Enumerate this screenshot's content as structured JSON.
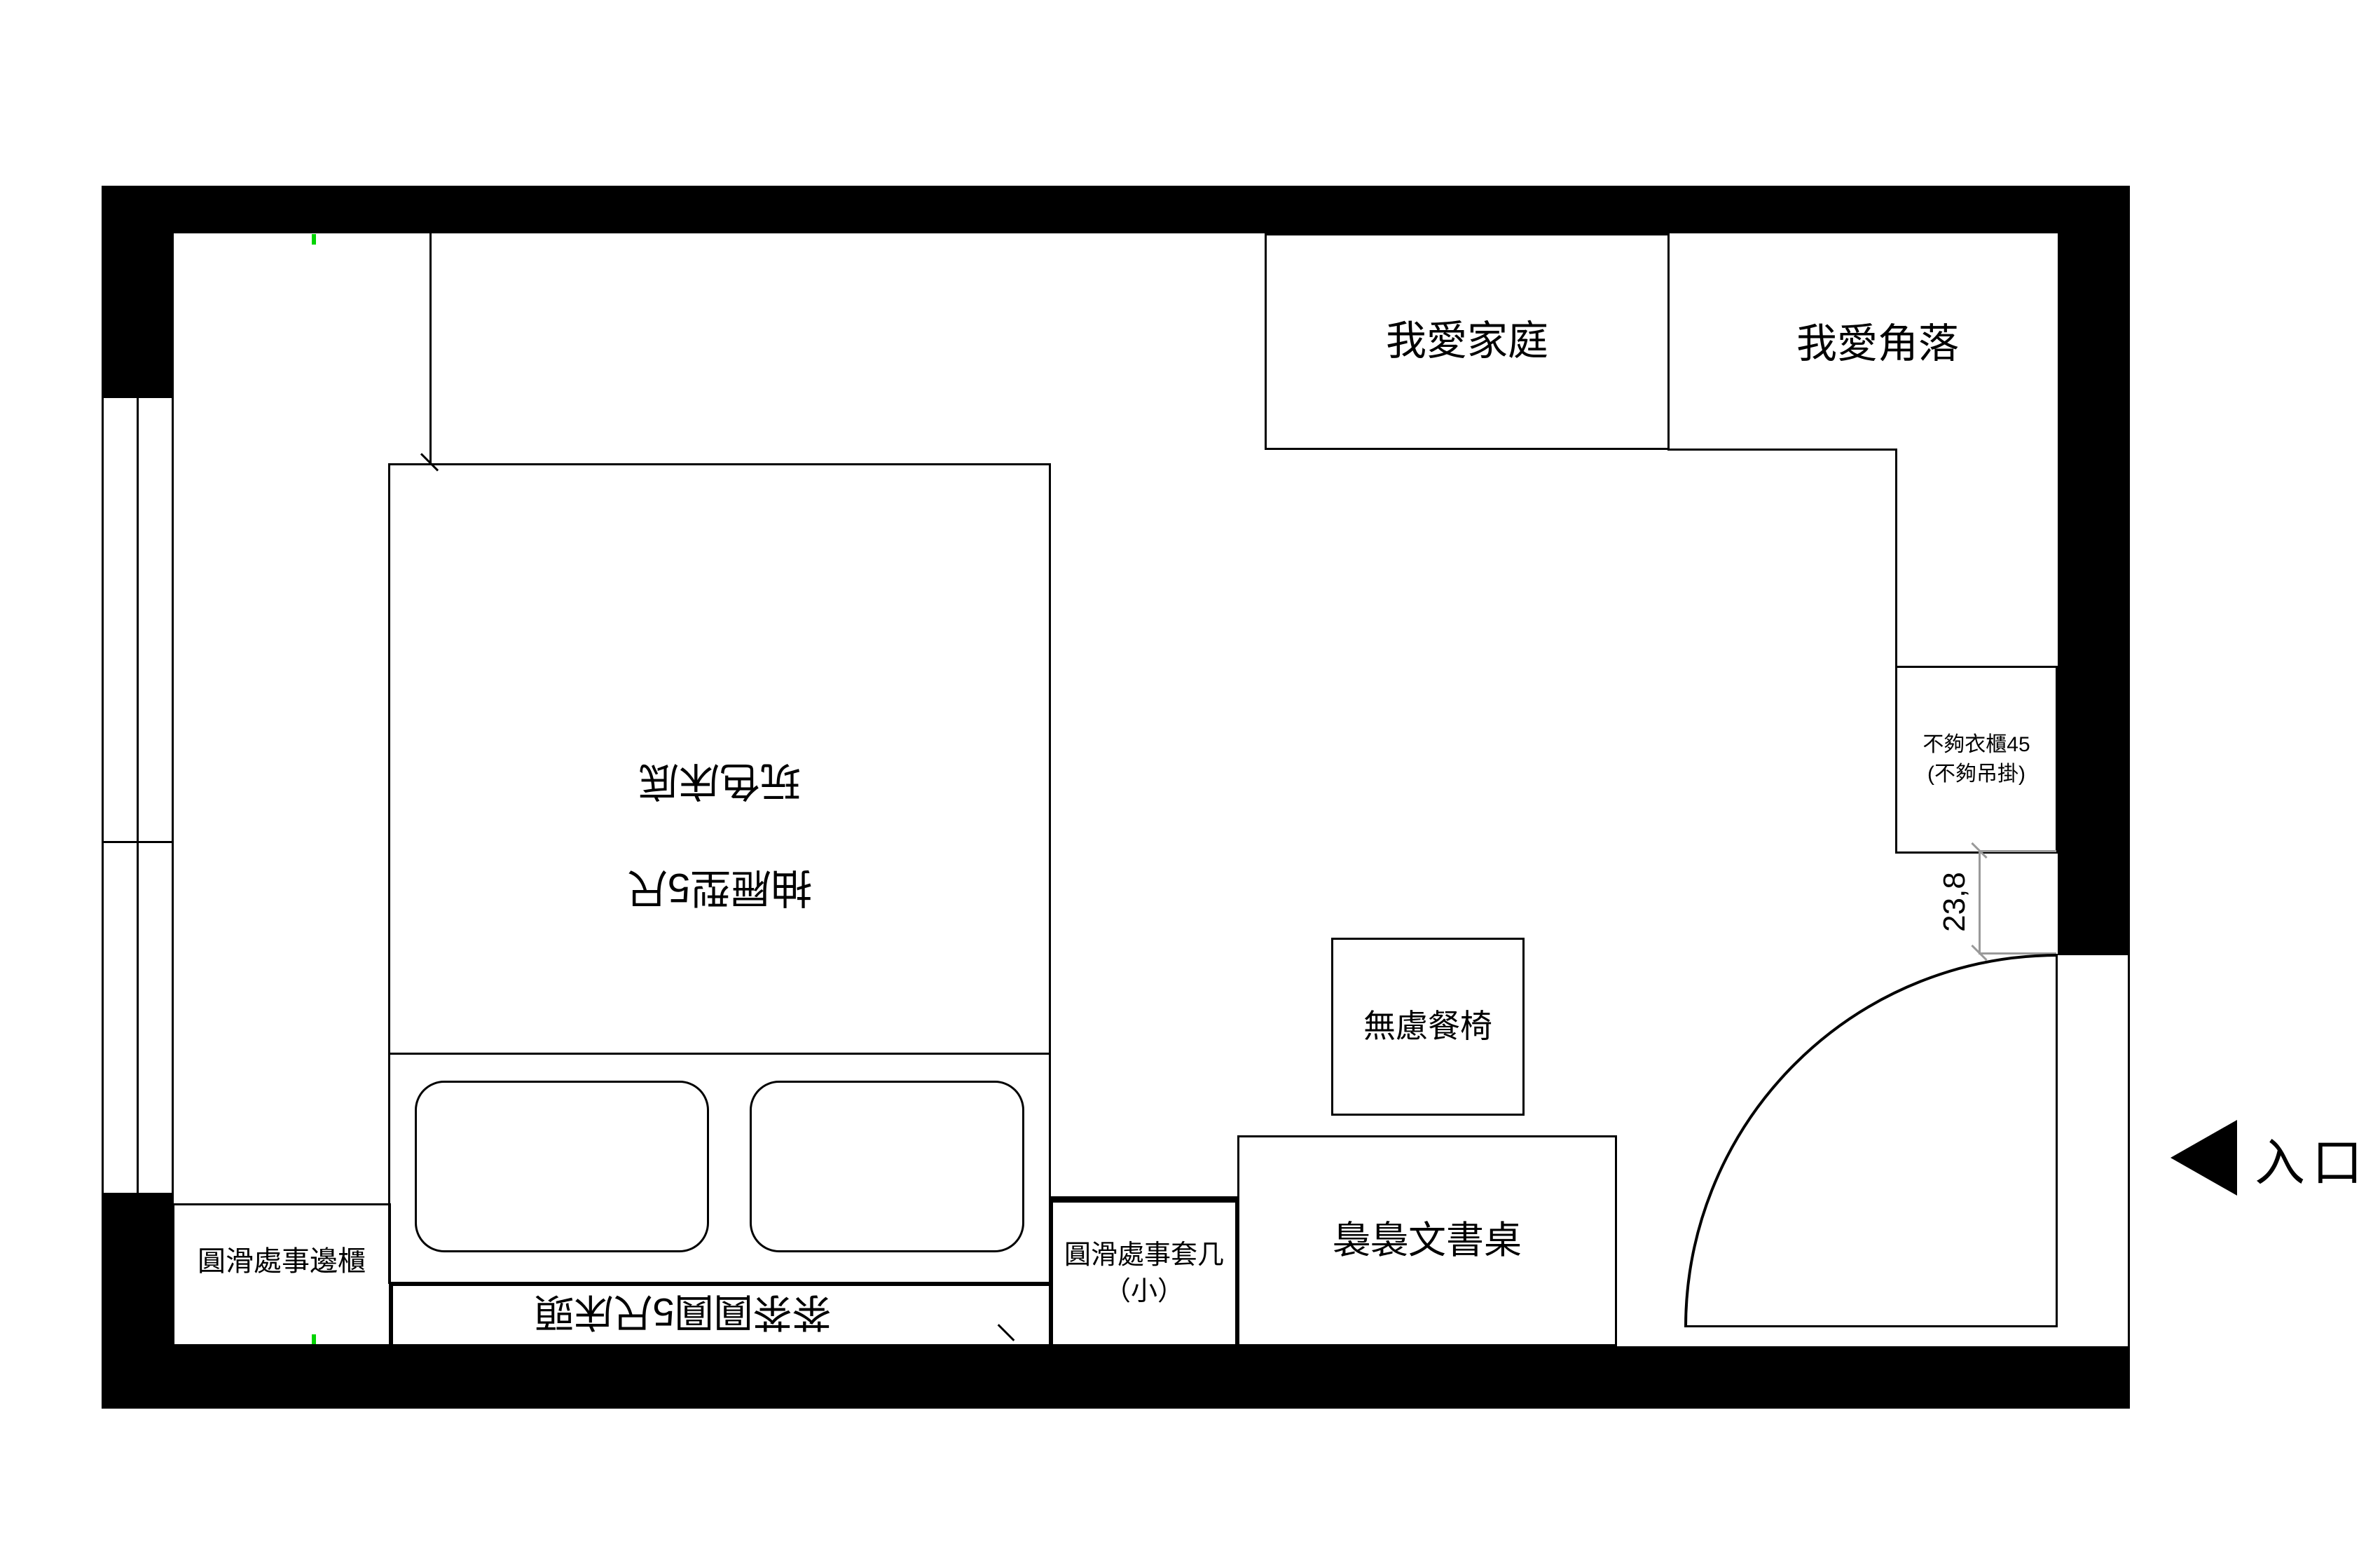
{
  "plan": {
    "labels": {
      "family_cabinet": "我愛家庭",
      "corner_cabinet": "我愛角落",
      "wardrobe_line1": "不夠衣櫃45",
      "wardrobe_line2": "(不夠吊掛)",
      "chair": "無慮餐椅",
      "desk": "裊裊文書桌",
      "side_table_line1": "圓滑處事套几",
      "side_table_line2": "（小）",
      "side_cabinet": "圓滑處事邊櫃",
      "bed_line1": "抽屜型5尺",
      "bed_line2": "玩色床底",
      "headboard": "茶茶圓圓5尺床頭"
    },
    "dimension": {
      "value": "23,8"
    },
    "entrance": {
      "label": "入口",
      "icon": "solid-left-triangle"
    },
    "colors": {
      "wall": "#000000",
      "line": "#000000",
      "dimension_line": "#9a9a9a",
      "marker_tick": "#00d400",
      "background": "#ffffff"
    }
  }
}
